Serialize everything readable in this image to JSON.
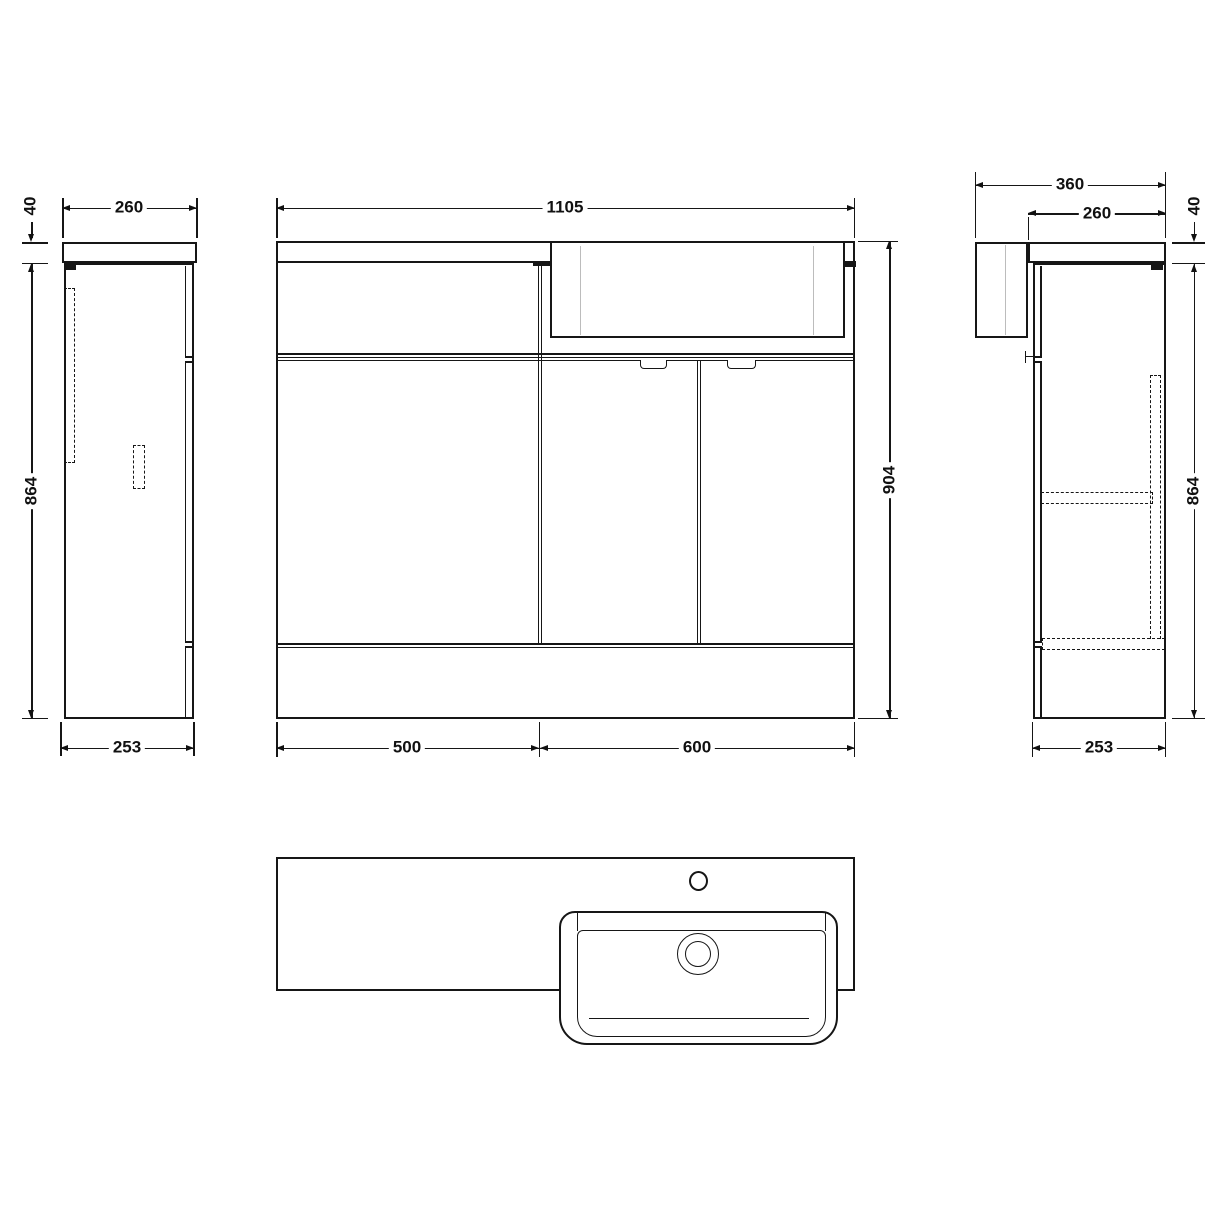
{
  "figure": {
    "type": "technical-drawing",
    "subject": "combination vanity unit with basin - dimensioned views",
    "units": "mm",
    "views": [
      "left-side",
      "front",
      "right-side",
      "plan"
    ]
  },
  "colors": {
    "line": "#161616",
    "light_line": "#bcbcbc",
    "background": "#ffffff"
  },
  "dims": {
    "lv_counter_thickness": "40",
    "lv_counter_depth": "260",
    "lv_height": "864",
    "lv_cabinet_depth": "253",
    "fv_overall_width": "1105",
    "fv_overall_height": "904",
    "fv_left_unit_width": "500",
    "fv_right_unit_width": "600",
    "rv_overall_depth": "360",
    "rv_counter_depth": "260",
    "rv_counter_thickness": "40",
    "rv_height": "864",
    "rv_cabinet_depth": "253"
  }
}
